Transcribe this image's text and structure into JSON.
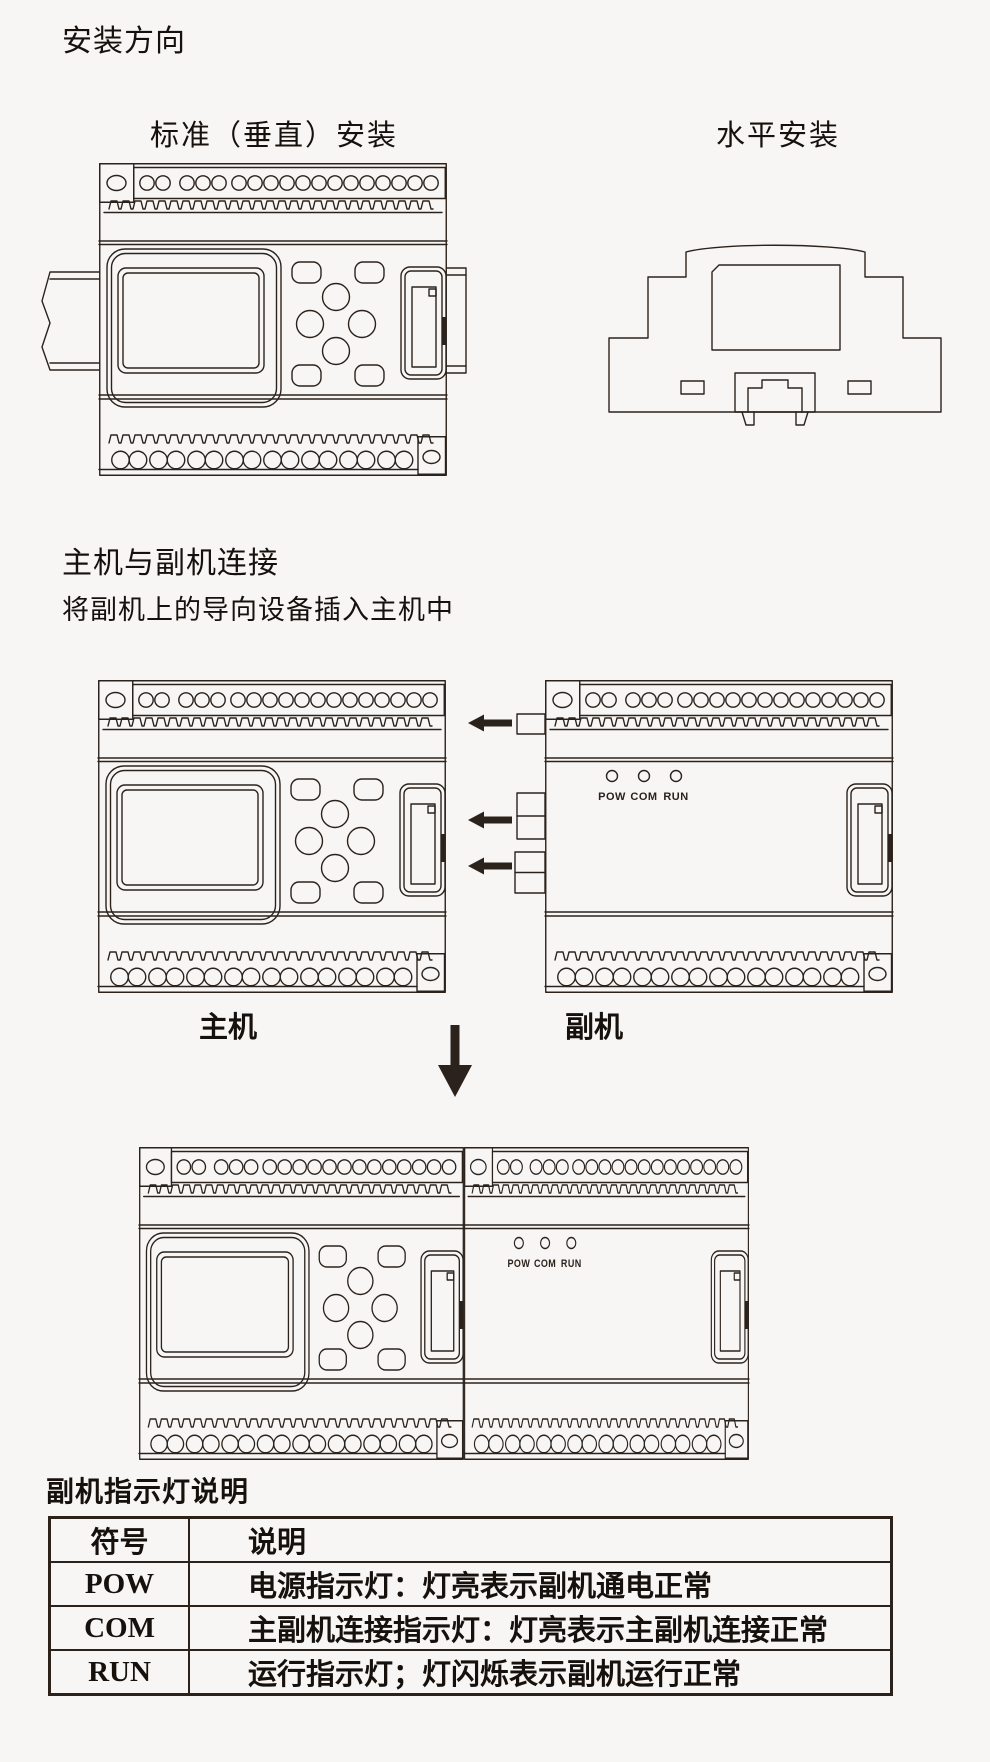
{
  "page": {
    "colors": {
      "background": "#f7f6f4",
      "line": "#2b221c",
      "text": "#17110d"
    },
    "title": "安装方向",
    "install_section": {
      "vertical_label": "标准（垂直）安装",
      "horizontal_label": "水平安装"
    },
    "connect_section": {
      "heading": "主机与副机连接",
      "instruction": "将副机上的导向设备插入主机中",
      "main_unit_label": "主机",
      "sub_unit_label": "副机"
    },
    "device": {
      "led_labels": [
        "POW",
        "COM",
        "RUN"
      ]
    },
    "indicator_section": {
      "heading": "副机指示灯说明",
      "table": {
        "headers": [
          "符号",
          "说明"
        ],
        "rows": [
          {
            "symbol": "POW",
            "description": "电源指示灯：灯亮表示副机通电正常"
          },
          {
            "symbol": "COM",
            "description": "主副机连接指示灯：灯亮表示主副机连接正常"
          },
          {
            "symbol": "RUN",
            "description": "运行指示灯；灯闪烁表示副机运行正常"
          }
        ]
      }
    }
  }
}
